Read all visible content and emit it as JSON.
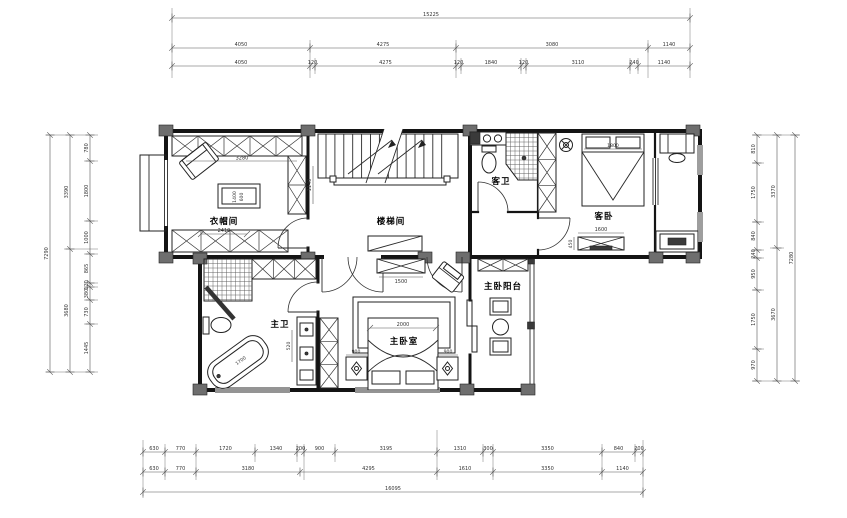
{
  "rooms": {
    "cloakroom": "衣帽间",
    "stairwell": "楼梯间",
    "guest_bath": "客卫",
    "guest_bedroom": "客卧",
    "master_bath": "主卫",
    "master_bedroom": "主卧室",
    "master_balcony": "主卧阳台"
  },
  "dims": {
    "top": {
      "total": "15225",
      "row1": [
        "4050",
        "4275",
        "3080",
        "1140"
      ],
      "row2": [
        "4050",
        "120",
        "4275",
        "120",
        "1840",
        "120",
        "3110",
        "240",
        "1140"
      ]
    },
    "bottom": {
      "row1": [
        "630",
        "770",
        "1720",
        "1340",
        "200",
        "900",
        "3195",
        "1310",
        "300",
        "3350",
        "840",
        "200"
      ],
      "row2": [
        "630",
        "770",
        "3180",
        "4295",
        "1610",
        "3350",
        "1140"
      ],
      "total": "16095"
    },
    "left": {
      "inner": [
        "780",
        "1800",
        "1000",
        "865",
        "120",
        "380",
        "730",
        "1445"
      ],
      "middle": [
        "3390",
        "3680"
      ],
      "total": "7290"
    },
    "right": {
      "inner": [
        "810",
        "1750",
        "840",
        "240",
        "950",
        "1750",
        "970"
      ],
      "middle": [
        "3370",
        "3670"
      ],
      "total": "7280"
    }
  },
  "furniture_dims": {
    "cloak_width": "2410",
    "cloak_wardrobe_top": "3280",
    "cloak_wardrobe_side": "1140",
    "island_length": "1400",
    "island_width": "600",
    "guest_bed_width": "1800",
    "guest_tv_width": "1600",
    "guest_tv_depth": "450",
    "master_bed_width": "2000",
    "nightstand_left": "900",
    "nightstand_right": "900",
    "master_tv_width": "1500",
    "vanity_height": "520",
    "bathtub_length": "1700"
  }
}
